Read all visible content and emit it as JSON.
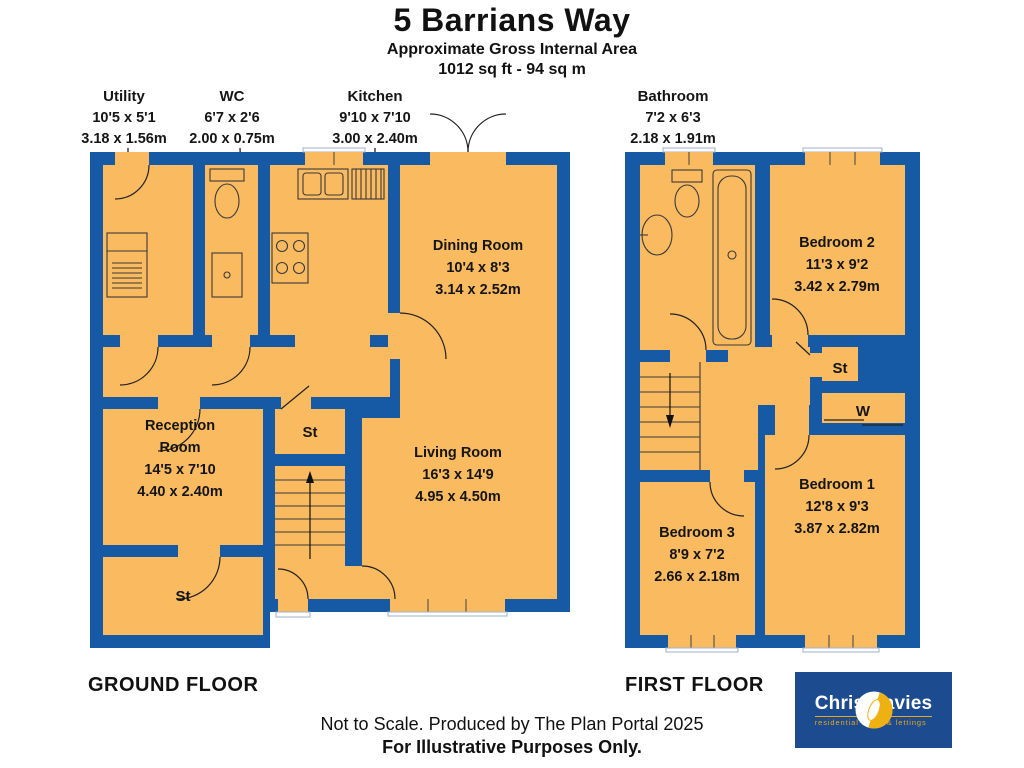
{
  "header": {
    "title": "5 Barrians Way",
    "subtitle1": "Approximate Gross Internal Area",
    "subtitle2": "1012 sq ft - 94 sq m"
  },
  "colors": {
    "wall_blue": "#1659a5",
    "room_orange": "#f9ba60",
    "logo_blue": "#1d4b8f",
    "logo_yellow": "#e8a71c"
  },
  "ground_floor": {
    "caption": "GROUND FLOOR",
    "callouts": {
      "utility": {
        "name": "Utility",
        "imperial": "10'5 x 5'1",
        "metric": "3.18 x 1.56m"
      },
      "wc": {
        "name": "WC",
        "imperial": "6'7 x 2'6",
        "metric": "2.00 x 0.75m"
      },
      "kitchen": {
        "name": "Kitchen",
        "imperial": "9'10 x 7'10",
        "metric": "3.00 x 2.40m"
      }
    },
    "rooms": {
      "dining": {
        "name": "Dining Room",
        "imperial": "10'4 x 8'3",
        "metric": "3.14 x 2.52m"
      },
      "living": {
        "name": "Living Room",
        "imperial": "16'3 x 14'9",
        "metric": "4.95 x 4.50m"
      },
      "reception": {
        "name_line1": "Reception",
        "name_line2": "Room",
        "imperial": "14'5 x 7'10",
        "metric": "4.40 x 2.40m"
      },
      "storage_hall": {
        "name": "St"
      },
      "storage_front": {
        "name": "St"
      }
    }
  },
  "first_floor": {
    "caption": "FIRST FLOOR",
    "callouts": {
      "bathroom": {
        "name": "Bathroom",
        "imperial": "7'2 x 6'3",
        "metric": "2.18 x 1.91m"
      }
    },
    "rooms": {
      "bedroom2": {
        "name": "Bedroom 2",
        "imperial": "11'3 x 9'2",
        "metric": "3.42 x 2.79m"
      },
      "bedroom1": {
        "name": "Bedroom 1",
        "imperial": "12'8 x 9'3",
        "metric": "3.87 x 2.82m"
      },
      "bedroom3": {
        "name": "Bedroom 3",
        "imperial": "8'9 x 7'2",
        "metric": "2.66 x 2.18m"
      },
      "storage": {
        "name": "St"
      },
      "wardrobe": {
        "name": "W"
      }
    }
  },
  "footer": {
    "line1": "Not to Scale. Produced by The Plan Portal 2025",
    "line2": "For Illustrative Purposes Only."
  },
  "logo": {
    "name": "Chris Davies",
    "tagline": "residential sales & lettings"
  }
}
